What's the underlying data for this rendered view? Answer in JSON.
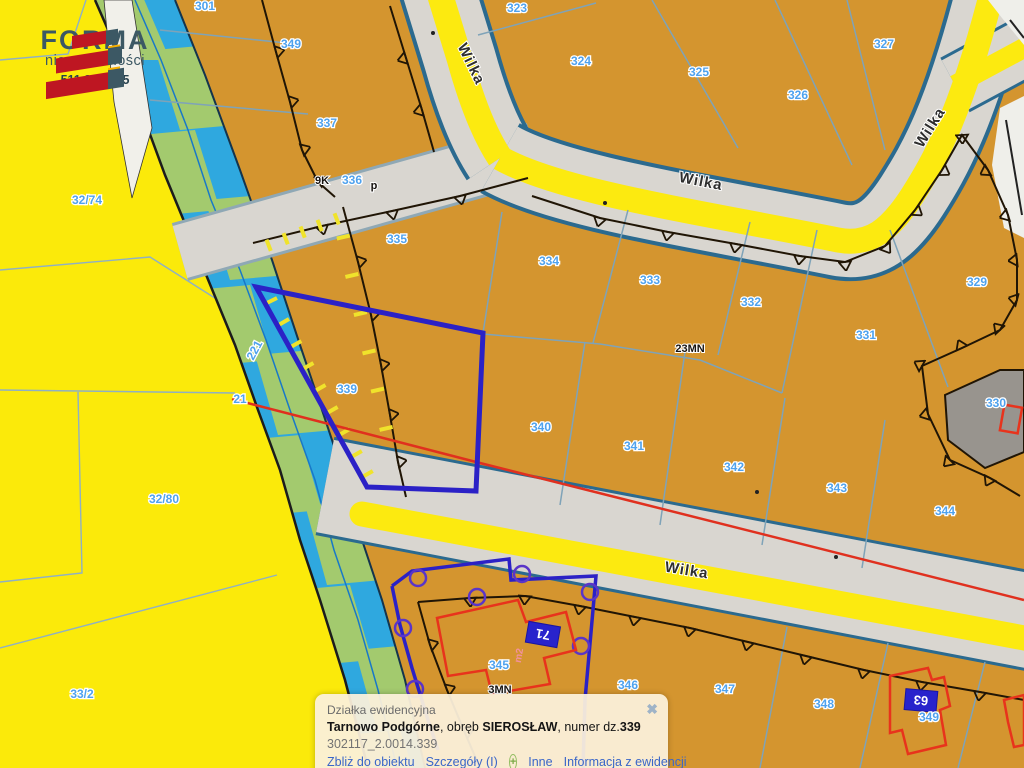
{
  "logo": {
    "brand": "FORMA",
    "tagline": "nieruchomości",
    "phone": "511 893 075"
  },
  "popup": {
    "type_label": "Działka ewidencyjna",
    "title": {
      "municipality": "Tarnowo Podgórne",
      "obreb_label": ", obręb ",
      "obreb": "SIEROSŁAW",
      "number_label": ", numer dz.",
      "number": "339"
    },
    "parcel_id": "302117_2.0014.339",
    "links": {
      "zoom": "Zbliż do obiektu",
      "details": "Szczegóły (I)",
      "other": "Inne",
      "info": "Informacja z ewidencji"
    },
    "plus_icon": "+",
    "close_icon": "✖"
  },
  "map": {
    "street_labels": [
      {
        "t": "Wilka",
        "x": 467,
        "y": 66,
        "r": 64
      },
      {
        "t": "Wilka",
        "x": 700,
        "y": 186,
        "r": 11
      },
      {
        "t": "Wilka",
        "x": 934,
        "y": 130,
        "r": -58
      },
      {
        "t": "Wilka",
        "x": 686,
        "y": 575,
        "r": 9
      }
    ],
    "zone_labels": [
      {
        "t": "23MN",
        "x": 690,
        "y": 352
      },
      {
        "t": "3MN",
        "x": 500,
        "y": 693
      },
      {
        "t": "9K",
        "x": 322,
        "y": 184
      },
      {
        "t": "p",
        "x": 374,
        "y": 189
      }
    ],
    "parcel_labels": [
      {
        "t": "301",
        "x": 205,
        "y": 10
      },
      {
        "t": "349",
        "x": 291,
        "y": 48
      },
      {
        "t": "337",
        "x": 327,
        "y": 127
      },
      {
        "t": "323",
        "x": 517,
        "y": 12
      },
      {
        "t": "324",
        "x": 581,
        "y": 65
      },
      {
        "t": "325",
        "x": 699,
        "y": 76
      },
      {
        "t": "326",
        "x": 798,
        "y": 99
      },
      {
        "t": "327",
        "x": 884,
        "y": 48
      },
      {
        "t": "336",
        "x": 352,
        "y": 184
      },
      {
        "t": "335",
        "x": 397,
        "y": 243
      },
      {
        "t": "334",
        "x": 549,
        "y": 265
      },
      {
        "t": "333",
        "x": 650,
        "y": 284
      },
      {
        "t": "332",
        "x": 751,
        "y": 306
      },
      {
        "t": "331",
        "x": 866,
        "y": 339
      },
      {
        "t": "329",
        "x": 977,
        "y": 286
      },
      {
        "t": "330",
        "x": 996,
        "y": 407
      },
      {
        "t": "221",
        "x": 258,
        "y": 352,
        "r": -62
      },
      {
        "t": "21",
        "x": 240,
        "y": 403
      },
      {
        "t": "32/74",
        "x": 87,
        "y": 204
      },
      {
        "t": "32/80",
        "x": 164,
        "y": 503
      },
      {
        "t": "33/2",
        "x": 82,
        "y": 698
      },
      {
        "t": "339",
        "x": 347,
        "y": 393
      },
      {
        "t": "340",
        "x": 541,
        "y": 431
      },
      {
        "t": "341",
        "x": 634,
        "y": 450
      },
      {
        "t": "342",
        "x": 734,
        "y": 471
      },
      {
        "t": "343",
        "x": 837,
        "y": 492
      },
      {
        "t": "344",
        "x": 945,
        "y": 515
      },
      {
        "t": "345",
        "x": 499,
        "y": 669
      },
      {
        "t": "346",
        "x": 628,
        "y": 689
      },
      {
        "t": "347",
        "x": 725,
        "y": 693
      },
      {
        "t": "348",
        "x": 824,
        "y": 708
      },
      {
        "t": "349",
        "x": 929,
        "y": 721
      }
    ],
    "house_numbers": {
      "h71": "71",
      "h63": "63"
    },
    "area_label": "m2",
    "colors": {
      "parcel_orange": "#D4952F",
      "field_yellow": "#FBEA0A",
      "water_cyan": "#2FA8DF",
      "vegetation_green": "#A3CA6E",
      "road_yellow": "#FCEA10",
      "sidewalk_gray": "#D9D6D0",
      "selection_blue": "#2B21C6",
      "red_line": "#E0301E",
      "building_red": "#E8331C",
      "label_blue": "#4FA2EE",
      "gray_parcel": "#98948E"
    }
  }
}
